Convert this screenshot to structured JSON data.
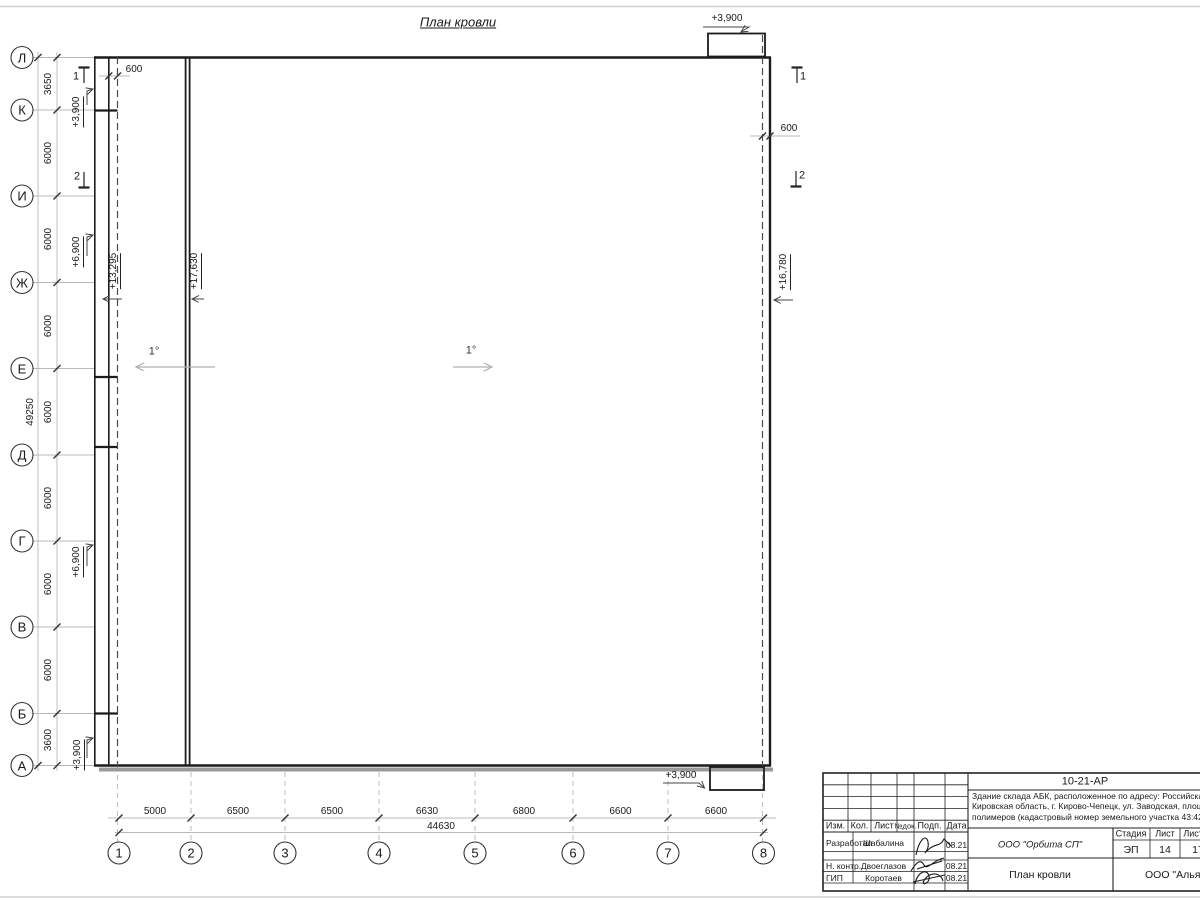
{
  "title": "План кровли",
  "axes": {
    "left": [
      "Л",
      "К",
      "И",
      "Ж",
      "Е",
      "Д",
      "Г",
      "В",
      "Б",
      "А"
    ],
    "bottom": [
      "1",
      "2",
      "3",
      "4",
      "5",
      "6",
      "7",
      "8"
    ]
  },
  "dims": {
    "left": [
      "3650",
      "6000",
      "6000",
      "6000",
      "6000",
      "6000",
      "6000",
      "6000",
      "3600"
    ],
    "left_total": "49250",
    "bottom": [
      "5000",
      "6500",
      "6500",
      "6630",
      "6800",
      "6600",
      "6600"
    ],
    "bottom_total": "44630",
    "parapet_left": "600",
    "parapet_right": "600"
  },
  "elevations": {
    "canopy_top": "+3,900",
    "canopy_bottom": "+3,900",
    "wall_top": "+3,900",
    "wall_upper_mid": "+6,900",
    "wall_lower_mid": "+6,900",
    "wall_bottom": "+3,900",
    "roof_low": "+13,295",
    "roof_main": "+17,630",
    "roof_right": "+16,780"
  },
  "slopes": {
    "left": "1°",
    "main": "1°"
  },
  "sections": {
    "one": "1",
    "two": "2"
  },
  "title_block": {
    "doc_number": "10-21-АР",
    "address_line1": "Здание склада АБК, расположенное по адресу: Российская Феде",
    "address_line2": "Кировская область, г. Кирово-Чепецк, ул. Заводская, площадка з",
    "address_line3": "полимеров (кадастровый номер земельного участка 43:42:0000",
    "columns": {
      "izm": "Изм.",
      "kol": "Кол.",
      "list": "Лист",
      "ndok": "№док.",
      "podp": "Подп.",
      "data": "Дата"
    },
    "rows": [
      {
        "role": "Разработал",
        "name": "Шабалина",
        "date": "08.21"
      },
      {
        "role": "Н. контр.",
        "name": "Двоеглазов",
        "date": "08.21"
      },
      {
        "role": "ГИП",
        "name": "Коротаев",
        "date": "08.21"
      }
    ],
    "org": "ООО \"Орбита СП\"",
    "stage_label": "Стадия",
    "sheet_label": "Лист",
    "sheets_label": "Листов",
    "stage": "ЭП",
    "sheet": "14",
    "sheets": "17",
    "drawing_name": "План кровли",
    "company": "ООО \"Альянс"
  }
}
